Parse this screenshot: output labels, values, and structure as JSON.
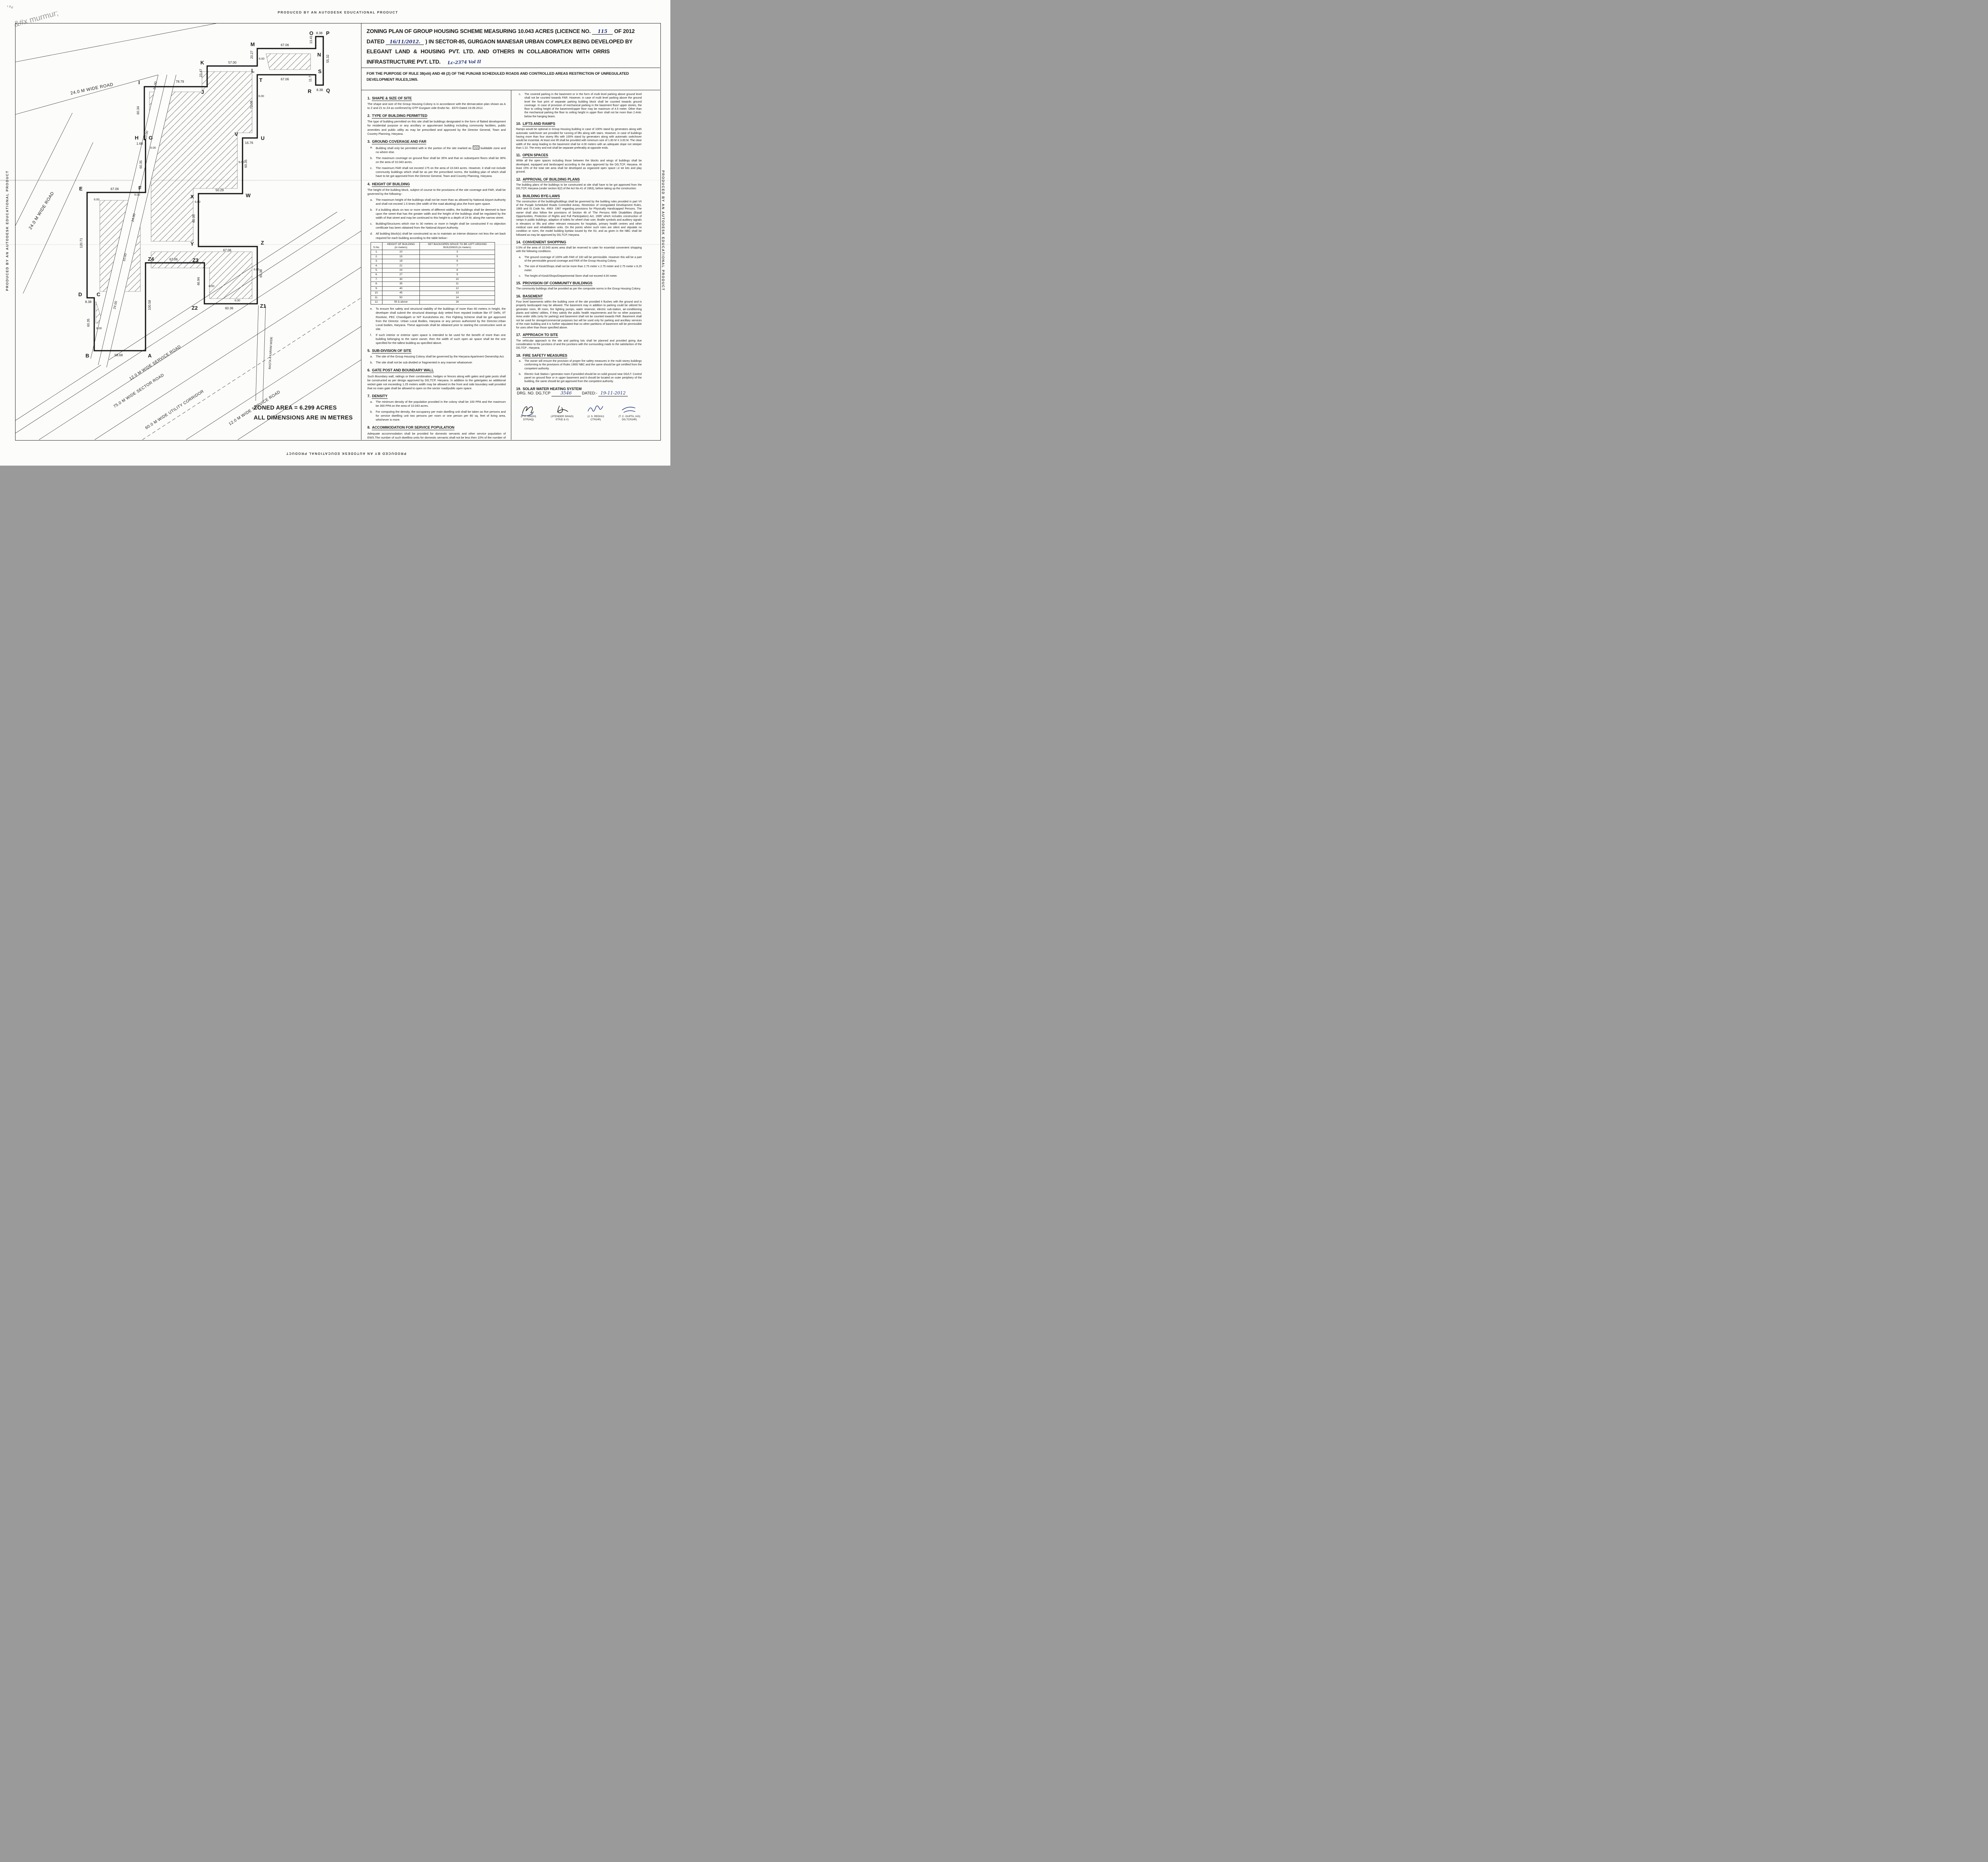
{
  "watermark": "PRODUCED BY AN AUTODESK EDUCATIONAL PRODUCT",
  "title": {
    "line1_pre": "ZONING PLAN OF GROUP HOUSING SCHEME MEASURING 10.043 ACRES (LICENCE NO.",
    "licence_no_hw": "115",
    "line1_post": "OF 2012",
    "line2_pre": "DATED",
    "dated_hw": "16/11/2012.",
    "line2_post": ") IN SECTOR-85, GURGAON MANESAR URBAN COMPLEX BEING DEVELOPED BY",
    "line3": "ELEGANT LAND & HOUSING PVT. LTD. AND OTHERS IN COLLABORATION WITH ORRIS",
    "line4": "INFRASTRUCTURE PVT. LTD.",
    "file_no_hw": "Lc-2374 Vol II",
    "subtitle": "FOR THE PURPOSE OF RULE 38(xlii) AND 48 (2) OF THE PUNJAB SCHEDULED ROADS  AND CONTROLLED AREAS RESTRICTION OF UNREGULATED DEVELOPMENT RULES,1965."
  },
  "plan": {
    "zoned_area_line1": "ZONED AREA = 6.299 ACRES",
    "zoned_area_line2": "ALL DIMENSIONS ARE IN METRES",
    "rasta": "RASTA 4 KARAM WIDE",
    "roads": [
      "24.0 M WIDE ROAD",
      "24.0 M WIDE ROAD",
      "12.0 M WIDE  SERVICE ROAD",
      "75.0 M WIDE SECTOR ROAD",
      "60.0 M WIDE UTILITY CORRIDOR",
      "12.0 M WIDE SERVICE ROAD"
    ],
    "vertices": [
      "I",
      "J",
      "K",
      "L",
      "M",
      "N",
      "O",
      "P",
      "Q",
      "R",
      "S",
      "T",
      "U",
      "V",
      "W",
      "X",
      "Y",
      "Z",
      "Z1",
      "Z2",
      "Z3",
      "Z4",
      "A",
      "B",
      "C",
      "D",
      "E",
      "F",
      "G",
      "H"
    ],
    "dims": [
      "78.79",
      "23.47",
      "57.00",
      "20.27",
      "67.06",
      "13.41",
      "8.38",
      "55.32",
      "8.38",
      "11.73",
      "67.06",
      "72.08",
      "16.76",
      "60.35",
      "50.29",
      "60.35",
      "67.06",
      "65.38",
      "60.36",
      "46.94",
      "67.06",
      "100.58",
      "58.68",
      "60.35",
      "8.38",
      "120.71",
      "67.06",
      "60.35",
      "1.68",
      "60.34"
    ],
    "six": "6.00",
    "w24": "24.00",
    "w10": "10.00"
  },
  "table": {
    "headers": [
      "S.No.",
      "HEIGHT OF BUILDING\n(in meters)",
      "SET BACK/OPEN SPACE TO BE LEFT AROUND\nBUILDINGS.(in meters)"
    ],
    "rows": [
      [
        "1.",
        "10",
        "3"
      ],
      [
        "2.",
        "15",
        "5"
      ],
      [
        "3.",
        "18",
        "6"
      ],
      [
        "4.",
        "21",
        "7"
      ],
      [
        "5.",
        "24",
        "8"
      ],
      [
        "6.",
        "27",
        "9"
      ],
      [
        "7.",
        "30",
        "10"
      ],
      [
        "8.",
        "35",
        "11"
      ],
      [
        "9.",
        "40",
        "12"
      ],
      [
        "10.",
        "45",
        "13"
      ],
      [
        "11.",
        "50",
        "14"
      ],
      [
        "12.",
        "55 & above",
        "16"
      ]
    ]
  },
  "sections_left": [
    {
      "no": "1.",
      "title": "SHAPE & SIZE OF SITE",
      "body": [
        {
          "t": "The shape and size of the Group Housing Colony is in accordance with the demarcation plan shown as A to Z and Z1 to Z4 as confirmed by DTP Gurgaon vide Endst No . 8370 Dated 19.09.2012."
        }
      ]
    },
    {
      "no": "2.",
      "title": "TYPE OF BUILDING PERMITTED",
      "body": [
        {
          "t": "The type of building permitted on this site shall be buildings designated in the form of flatted development for residential purpose or any ancillary or appurtenant building  including community facilities, public amenities and public utility as may be prescribed and approved by the Director General, Town and Country Planning, Haryana."
        }
      ]
    },
    {
      "no": "3.",
      "title": "GROUND COVERAGE AND FAR",
      "body": [
        {
          "l": "a.",
          "t": "Building shall only be permitted with in the portion of the site marked as",
          "hatch": true,
          "t2": "buildable  zone and no where else."
        },
        {
          "l": "b.",
          "t": "The maximum coverage on ground floor shall be 35% and that on subsequent floors shall be 30% on the area of 10.043 acres."
        },
        {
          "l": "c.",
          "t": "The maximum FAR shall not exceed 175 on the area of 10.043 acres. However, it shall not include community buildings which shall be as per the prescribed norms, the building plan of which shall  have to be got  approved from the Director General, Town and Country Planning, Haryana."
        }
      ]
    },
    {
      "no": "4.",
      "title": "HEIGHT OF BUILDING",
      "body": [
        {
          "t": "The height of the building block, subject of course to the provisions of the site coverage and FAR, shall be governed by the following:-"
        },
        {
          "l": "a.",
          "t": "The maximum height of the buildings shall not be more than as allowed by National Airport Authority and shall not exceed 1.5 times (the width of the road abutting) plus   the front  open space."
        },
        {
          "l": "b.",
          "t": "If a building abuts on two or more streets of different widths, the buildings shall be deemed to face  upon the street that has the greater width and the height of the buildings shall be regulated by the width of that street and may be continued to this height to a depth of 24 M, along the narrow street."
        },
        {
          "l": "c.",
          "t": "Building/Structures which rise to 30 meters or more in height shall be constructed if no objection certificate has been obtained from the National Airport Authority."
        },
        {
          "l": "d.",
          "t": "All building block(s) shall be constructed so as to maintain an interse distance not less the set back required for each building according to the table below:-"
        },
        {
          "table": true
        },
        {
          "l": "e.",
          "t": "To ensure fire safety and structural stability of the buildings of more than 60 meters in height, the developer shall submit the structural drawings duly vetted from reputed institute like IIT Delhi, IIT Roorkee, PEC Chandigarh or NIT Kurukshetra etc. Fire Fighting Scheme shall be got approved from the Director. Urban Local Bodies, Haryana or any person authorized by the Director,Urban Local bodies, Haryana. These approvals shall be obtained prior to starting the construction work at site."
        },
        {
          "l": "f.",
          "t": "If such interior or exterior open space is intended to be used for the benefit of more than one building belonging to the same owner, then the width of such open air space  shall be the one specified for the tallest building as specified above."
        }
      ]
    },
    {
      "no": "5.",
      "title": "SUB-DIVISION OF SITE",
      "body": [
        {
          "l": "a.",
          "t": "The site of the Group Housing Colony shall be governed by the Haryana Apartment  Ownership Act."
        },
        {
          "l": "b.",
          "t": "The site shall not be sub divided or fragmented in any manner whatsoever."
        }
      ]
    },
    {
      "no": "6.",
      "title": "GATE POST AND BOUNDARY WALL",
      "body": [
        {
          "t": "Such Boundary wall, railings or their combination, hedges or fences along with gates  and gate posts shall be constructed as per design approved by DG,TCP, Haryana. In addition to the gate/gates an additional wicket gate not exceeding 1.25 meters width may be allowed in the front and side boundary wall provided that no main gate shall be allowed to open on the sector road/public open space."
        }
      ]
    },
    {
      "no": "7.",
      "title": "DENSITY",
      "body": [
        {
          "l": "a.",
          "t": "The minimum density of the population provided in the colony shall be 100 PPA and the maximum be 300 PPA on the area of 10.043 acres."
        },
        {
          "l": "b.",
          "t": "For computing the density, the occupancy per main dwelling unit shall be taken as five persons and for service dwelling unit two persons per room or one person per 80 sq. feet  of living area, whichever is more."
        }
      ]
    },
    {
      "no": "8.",
      "title": "ACCOMMODATION FOR SERVICE POPULATION",
      "body": [
        {
          "t": "Adequate accommodation shall be provided for domestic servants and other service  population of EWS.The number of such dwelling units for domestic servants shall not be less then 10% of the number of main dwelling units and the carpet area of such a unit if attached to the main units shall not be less than 140 sq.ft. In addition 15% of  the total number of dwelling units having a minimum area of 200 sq.ft shall be earmarked for E.W.S category."
        }
      ]
    },
    {
      "no": "9.",
      "title": "PARKING",
      "body": [
        {
          "l": "a.",
          "t": "Parking space shall be provided @ 1.5 Equivalent Car Space for each dwelling unit. These parking spaces shall be allotted only to the flat holders and shall not be  allotted, leased, sold or transferred in any manner to the third party. The area for  parking per car shall be as under:-"
        },
        {
          "plain": "i)  Basement. 35 sqm."
        },
        {
          "plain": "ii) Stilts.       30 sqm."
        },
        {
          "plain": "iii) Open.      25 sqm."
        },
        {
          "l": "b.",
          "t": "At least 75% of the equivalent car spaces shall be provided in the form of covered parking.Further minimum 5% of the total parking will be made available to the EWS category flats."
        }
      ]
    }
  ],
  "sections_right": [
    {
      "no": "",
      "title": "",
      "body": [
        {
          "l": "c.",
          "t": "The covered parking in the basement or in the form of multi level parking above ground level shall not be counted towards FAR. However, in case of multi level parking above the ground level the foot print of separate parking building block shall be counted towards ground coverage. In case of provision of mechanical parking in the basement floor/ upper stories, the floor to ceiling height of the basement/upper floor may be maximum of 4.5 meter. Other than the mechanical parking the floor to ceiling height in upper floor shall not be more than 2.4mtr. below the hanging beam."
        }
      ]
    },
    {
      "no": "10.",
      "title": "LIFTS AND RAMPS",
      "body": [
        {
          "t": "Ramps would be optional in Group Housing building in case of 100% stand by generators   along with automatic switchover are provided for running of lifts along with  stairs.  However, in case of buildings having more than four storey lifts with 100% stand by generators along with automatic switchover would be essential. At least one lift shall be provided with minimum size of 1.80 M X 3.00 M. The clear width of the ramp leading to the basement shall be 4.00 meters with an adequate slope not steeper than 1:10. The entry and exit shall be separate preferably at opposite ends."
        }
      ]
    },
    {
      "no": "11.",
      "title": "OPEN SPACES",
      "body": [
        {
          "t": "While all the open spaces including those between the blocks and wings of buildings shall be developed, equipped and landscaped  according to the plan approved by the DG,TCP, Haryana. At least 15% of the total site area shall be developed as organized open space i.e tot lots and play ground."
        }
      ]
    },
    {
      "no": "12.",
      "title": "APPROVAL OF BUILDING PLANS",
      "body": [
        {
          "t": "The building plans of the buildings to be constructed at site shall have to be got approved from the DG,TCP, Haryana (under section 8(2) of the Act No.41 of 1963), before taking  up the construction."
        }
      ]
    },
    {
      "no": "13.",
      "title": "BUILDING BYE-LAWS",
      "body": [
        {
          "t": "The construction of the building/buildings shall be governed by the building rules provided in part VII of the Punjab Scheduled Roads Controlled Areas, Restriction of Unregulated Development Rules, 1965 and IS Code No. 4963- 1987 regarding provisions for Physically Handicapped Persons. The owner shall also follow the provisions of Section 46 of 'The Persons With Disabilities (Equal Opportunities, Protection of Rights and Full Participation) Act, 1995' which includes construction of ramps in public buildings, adaption of toilets for wheel chair user, Braille symbols and auditory signals in elevators or lifts and other relevant measures for hospitals, primary health centres and other medical care and rehabilitation units. On the points where such rules are silent and stipulate no condition or norm, the model building byelaw issued by the ISI, and as given in the NBC shall be followed as may be approved by DG,TCP, Haryana."
        }
      ]
    },
    {
      "no": "14.",
      "title": "CONVENIENT SHOPPING",
      "body": [
        {
          "t": "0.5% of the area of 10.043 acres area shall be reserved to cater for essential convenient shopping with the following conditions."
        },
        {
          "l": "a.",
          "t": "The ground coverage of 100% with FAR of 100 will be permissible. However this will be a part of the permissible ground coverage and FAR of the Group Housing Colony."
        },
        {
          "l": "b.",
          "t": "The size of Kiosk/Shops shall not be more than 2.75 meter x 2.75 meter and 2.75 meter x 8.25 meter."
        },
        {
          "l": "c.",
          "t": "The height of Kiosk/Shops/Departmental Store shall not exceed 4.00 meter."
        }
      ]
    },
    {
      "no": "15.",
      "title": "PROVISION OF COMMUNITY BUILDINGS",
      "body": [
        {
          "t": "The community buildings shall be provided as per the composite norms in the Group  Housing Colony."
        }
      ]
    },
    {
      "no": "16.",
      "title": "BASEMENT",
      "body": [
        {
          "t": "Four level basements within the building zone of the site provided it flushes with the  ground and is properly landscaped may be allowed. The basement may in addition to parking could be utilized for generator room, lift room, fire fighting pumps, water reservoir, electric sub-station, air-conditioning plants and toilets/ utilities, if they satisfy the public health requirements and for no other purposes. Area under stilts (only for parking) and basement shall not be counted towards FAR. Basement shall not be used for storage/commercial purposes but will be used only for parking and ancillary services of the main building and it is further stipulated that no other partitions of basement will be permissible for uses other than those specified above."
        }
      ]
    },
    {
      "no": "17.",
      "title": "APPROACH TO SITE",
      "body": [
        {
          "t": "The vehicular approach to the site and parking lots shall be planned and provided giving due consideration to the junctions of and the junctions with the surrounding roads to the satisfaction of the DG,TCP   , Haryana."
        }
      ]
    },
    {
      "no": "18.",
      "title": "FIRE SAFETY MEASURES",
      "body": [
        {
          "l": "a.",
          "t": "The owner will ensure the provision of proper fire safety measures in the multi storey buildings conforming to the provisions of Rules 1965/ NBC and the same should be got certified from the competent authority."
        },
        {
          "l": "b.",
          "t": "Electric Sub Station / generator room if provided should be on solid ground near  DG/LT. Control panel on ground floor or in upper basement and it should be located on outer periphery of the building, the same should be got approved from the competent authority."
        }
      ]
    },
    {
      "no": "19.",
      "title": "SOLAR WATER HEATING SYSTEM",
      "body": [
        {
          "t": "The provision of solar water heating system shall be as per norms specified by HAREDA and shall be made operational in each building block before applying for an occupation certificate."
        }
      ]
    },
    {
      "no": "20.",
      "title": "RAIN WATER HARVESTING SYSTEM",
      "body": [
        {
          "t": "The rain water harvesting system shall be provided as per Central Ground Water Authority norms/Haryana Govt. notification as applicable."
        }
      ]
    },
    {
      "no": "",
      "title": "",
      "body": [
        {
          "l": "21.",
          "t": "The colonizer shall obtain the clearance/NOC as per the provisions of the Notification No. S.O. 1533(E) Dated 14.9.2006 issued by Ministry of Environment and Forest, Government of India before starting the construction/ execution of development  works at site."
        },
        {
          "l": "22.",
          "t": "The coloniser/owner shall use only Compact Fluorescent Lamps fittings for internal lighting as  well as campus lighting."
        },
        {
          "l": "23.",
          "t": "That no separate zoning plan is approved for community sites earmarked within a Group Housing Colony. The community building/buildings shall be constructed by the coloniser/owner as per provision of The Haryana Development and Regulation of Urban Areas (Amendment and Validation) Act No. 4 of 2012, failing which the said site shall vest with the Government."
        },
        {
          "l": "24.",
          "t": "That the owner shall construct the EWS flats within 2 years and give the advertisement in the newspapers for inviting the application for EWS flats in their Group Housing Colony within 12 months from the issuance of sanction letter of this zoning plan."
        }
      ]
    }
  ],
  "drg": {
    "label_pre": "DRG. NO. DG,TCP",
    "number_hw": "3546",
    "label_dated": "DATED:-",
    "date_hw": "19-11-2012"
  },
  "signatories": [
    {
      "name": "(P. P. SINGH)",
      "title": "DTP(HQ)"
    },
    {
      "name": "(JITENDER SIHAG)",
      "title": "STP(E & V)"
    },
    {
      "name": "(J. S. REDHU)",
      "title": "CTP(HR)"
    },
    {
      "name": "(T. C. GUPTA, IAS)",
      "title": "DG,TCP(HR)"
    }
  ]
}
